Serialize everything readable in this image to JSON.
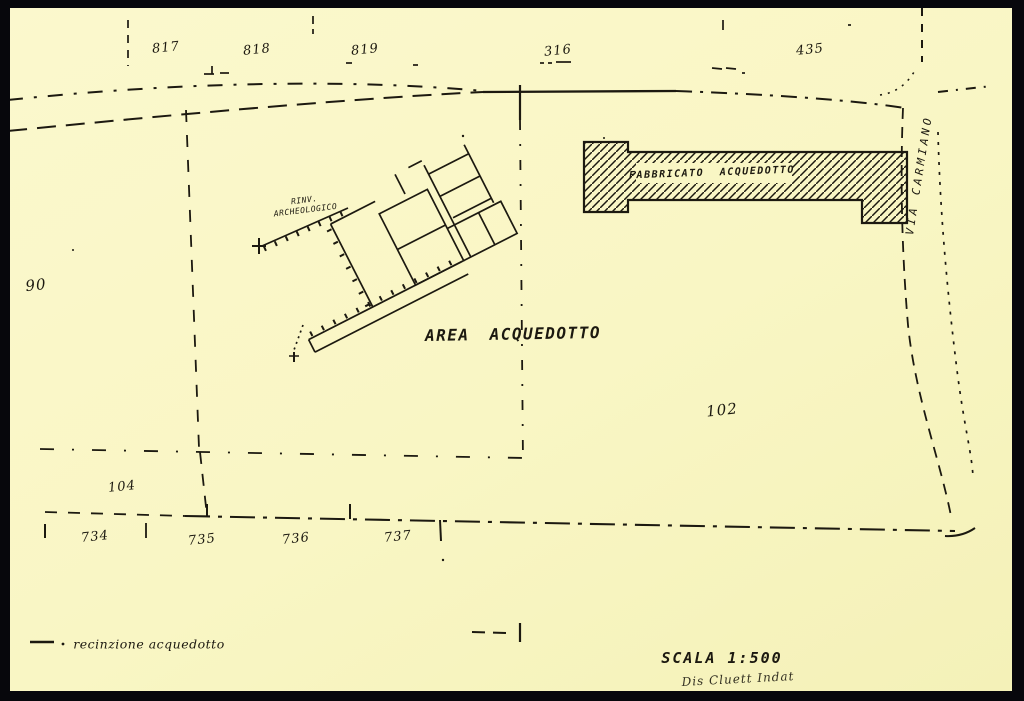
{
  "colors": {
    "paper": "#f9f6c4",
    "ink": "#1c1910",
    "frame": "#07070c"
  },
  "parcels": {
    "n817": "817",
    "n818": "818",
    "n819": "819",
    "n316": "316",
    "n435": "435",
    "n90": "90",
    "n102": "102",
    "n104": "104",
    "n734": "734",
    "n735": "735",
    "n736": "736",
    "n737": "737"
  },
  "labels": {
    "area_title": "AREA ACQUEDOTTO",
    "building": "FABBRICATO ACQUEDOTTO",
    "street": "VIA CARMIANO",
    "ruins_line1": "RINV.",
    "ruins_line2": "ARCHEOLOGICO",
    "scale": "SCALA 1:500",
    "signature": "Dis Cluett Indat"
  },
  "legend": {
    "label": "recinzione acquedotto"
  }
}
